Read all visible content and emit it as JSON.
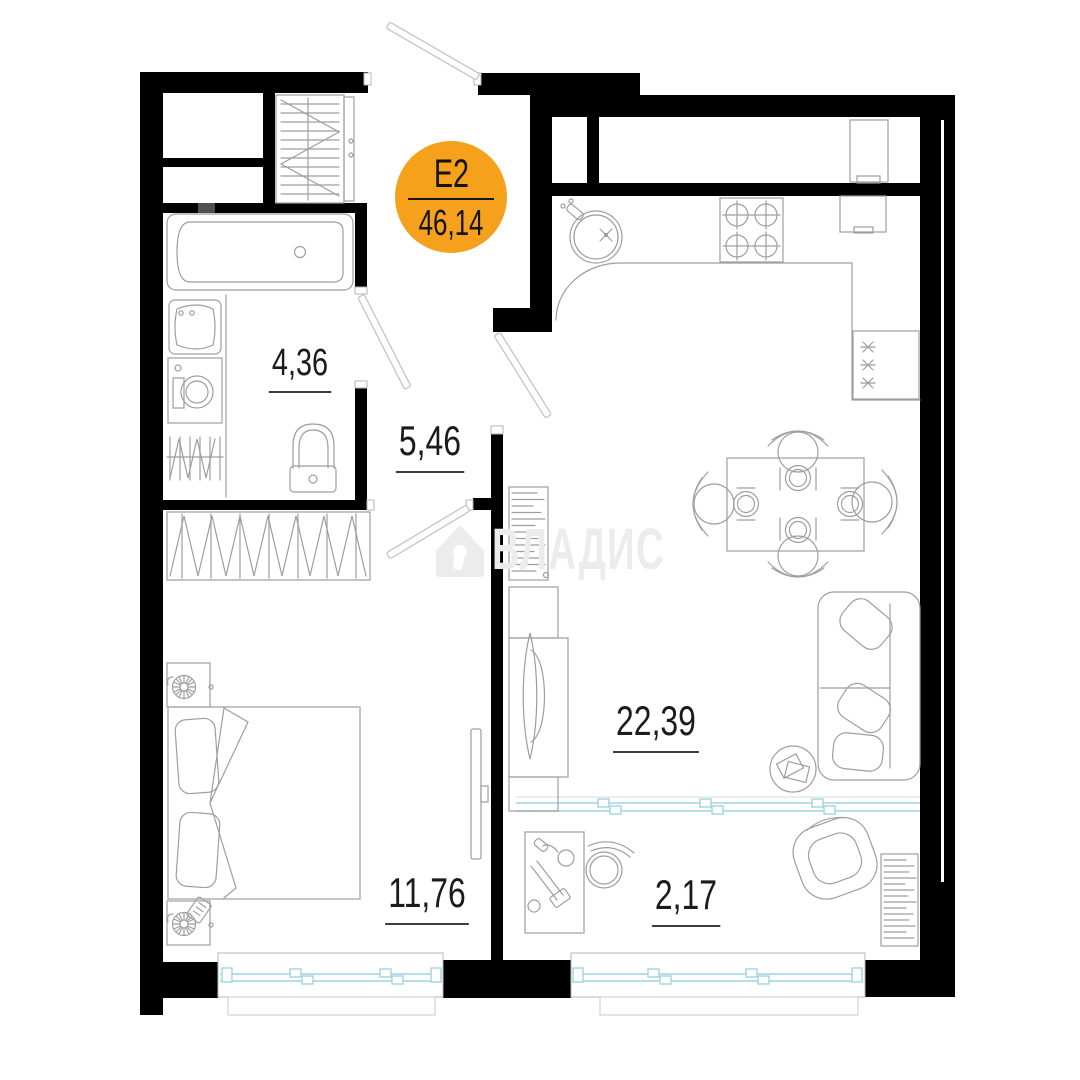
{
  "badge": {
    "unit": "E2",
    "total_area": "46,14"
  },
  "rooms": [
    {
      "name": "bathroom",
      "area": "4,36"
    },
    {
      "name": "hallway",
      "area": "5,46"
    },
    {
      "name": "kitchen-living-room",
      "area": "22,39"
    },
    {
      "name": "bedroom",
      "area": "11,76"
    },
    {
      "name": "balcony",
      "area": "2,17"
    }
  ],
  "watermark": {
    "text": "ВЛАДИС"
  },
  "colors": {
    "wall": "#000000",
    "accent": "#F6A11B",
    "window": "#9fd4e2",
    "furniture": "#9e9e9e",
    "watermark": "#ececec"
  }
}
